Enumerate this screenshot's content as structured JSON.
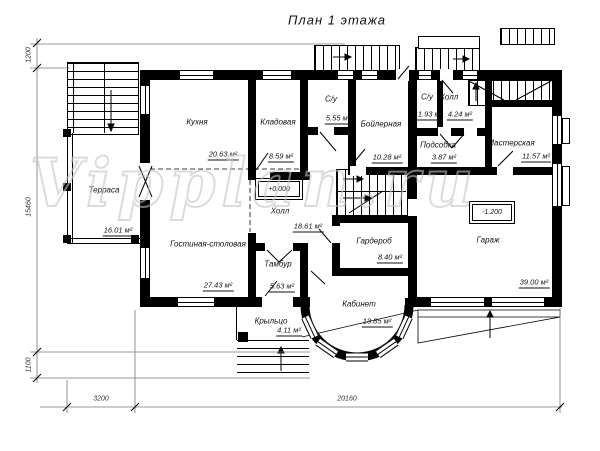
{
  "title": "План 1 этажа",
  "watermark": "Vipplan.ru",
  "colors": {
    "ink": "#000000",
    "watermark": "#c4c4c4"
  },
  "rooms": [
    {
      "name": "Терраса",
      "area": "16.01 м²"
    },
    {
      "name": "Кухня",
      "area": "20.63 м²"
    },
    {
      "name": "Кладовая",
      "area": "8.59 м²"
    },
    {
      "name": "С/у",
      "area": "5.55 м²"
    },
    {
      "name": "Бойлерная",
      "area": "10.28 м²"
    },
    {
      "name": "С/у",
      "area": "1.93 м²"
    },
    {
      "name": "Холл",
      "area": "4.24 м²"
    },
    {
      "name": "Подсобка",
      "area": "3.87 м²"
    },
    {
      "name": "Мастерская",
      "area": "11.57 м²"
    },
    {
      "name": "Холл",
      "area": "18.61 м²"
    },
    {
      "name": "Гостиная-столовая",
      "area": "27.43 м²"
    },
    {
      "name": "Тамбур",
      "area": "5.63 м²"
    },
    {
      "name": "Крыльцо",
      "area": "4.11 м²"
    },
    {
      "name": "Гардероб",
      "area": "8.40 м²"
    },
    {
      "name": "Кабинет",
      "area": "13.85 м²"
    },
    {
      "name": "Гараж",
      "area": "39.00 м²"
    }
  ],
  "elevations": {
    "main_floor": "+0.000",
    "garage": "-1.200"
  },
  "dimensions": {
    "left_top": "1200",
    "left_main": "15460",
    "left_bottom": "1100",
    "bottom_small": "3200",
    "bottom_main": "20160"
  }
}
